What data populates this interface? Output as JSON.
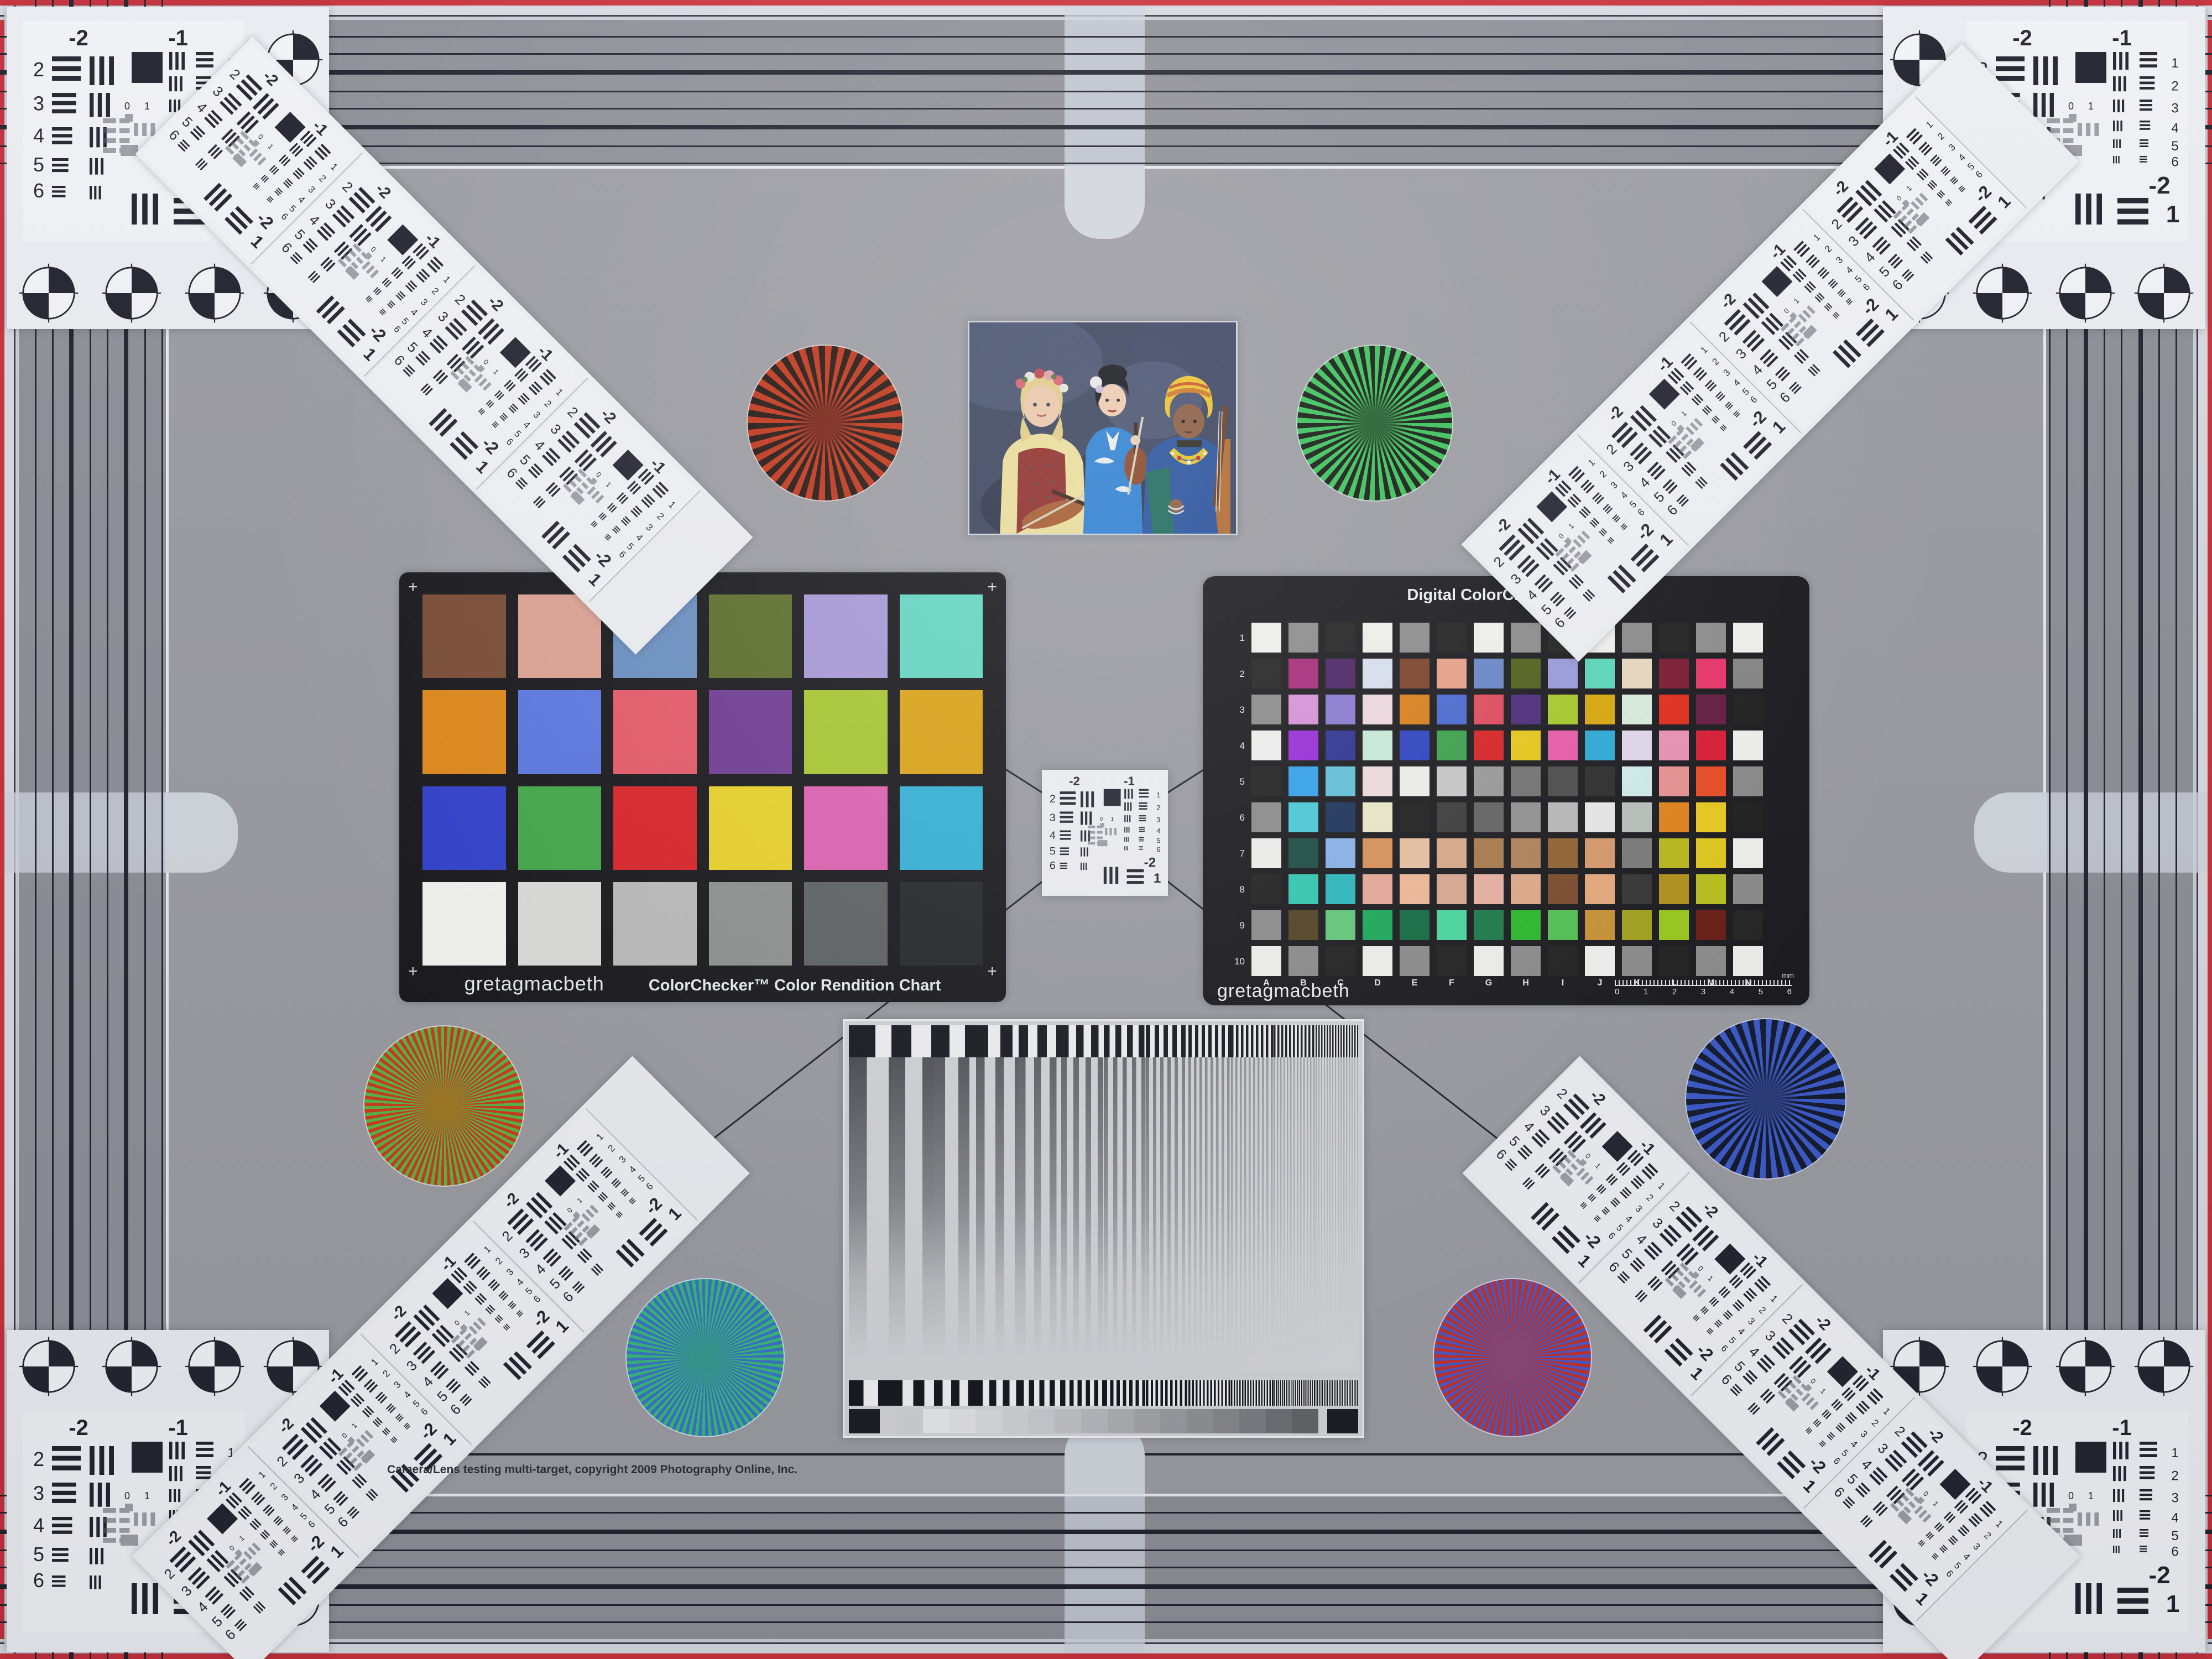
{
  "page": {
    "kind": "camera-lens-multi-target-test-chart"
  },
  "colors": {
    "edge_red": "#c8303c",
    "field_gray": "#9b9ba2",
    "band_gray": "#8e8e96",
    "line_ink": "#23232e"
  },
  "footer": {
    "copyright": "Camera/Lens testing multi-target, copyright 2009 Photography Online, Inc."
  },
  "colorchecker": {
    "brand": "gretagmacbeth",
    "title": "ColorChecker™ Color Rendition Chart",
    "corner_mark": "+",
    "patch_names": [
      "dark-skin",
      "light-skin",
      "blue-sky",
      "foliage",
      "blue-flower",
      "bluish-green",
      "orange",
      "purplish-blue",
      "moderate-red",
      "purple",
      "yellow-green",
      "orange-yellow",
      "blue",
      "green",
      "red",
      "yellow",
      "magenta",
      "cyan",
      "white",
      "neutral-8",
      "neutral-6.5",
      "neutral-5",
      "neutral-3.5",
      "black"
    ],
    "patches": [
      "#7a4b34",
      "#dda293",
      "#6a90c2",
      "#5c6e2a",
      "#a79ad8",
      "#63d8c2",
      "#e18818",
      "#5a78e2",
      "#e85a68",
      "#6e3a92",
      "#a9c930",
      "#dda414",
      "#3140cc",
      "#41a848",
      "#da2228",
      "#ead428",
      "#df62b2",
      "#32b2d8",
      "#f5f5f1",
      "#dddddb",
      "#bcbcbc",
      "#8f9190",
      "#5d6161",
      "#232527"
    ]
  },
  "sg": {
    "title": "Digital ColorChecker® SG",
    "brand": "gretagmacbeth",
    "row_labels": [
      "1",
      "2",
      "3",
      "4",
      "5",
      "6",
      "7",
      "8",
      "9",
      "10"
    ],
    "col_labels": [
      "A",
      "B",
      "C",
      "D",
      "E",
      "F",
      "G",
      "H",
      "I",
      "J",
      "K",
      "L",
      "M",
      "N"
    ],
    "ruler": {
      "ticks": [
        "0",
        "1",
        "2",
        "3",
        "4",
        "5",
        "6"
      ],
      "unit": "mm"
    },
    "patches": [
      [
        "#f2f2ee",
        "#8c8c8c",
        "#1f1f1f",
        "#f2f2ee",
        "#8c8c8c",
        "#1f1f1f",
        "#f2f2ee",
        "#8c8c8c",
        "#1f1f1f",
        "#f2f2ee",
        "#8c8c8c",
        "#1f1f1f",
        "#8c8c8c",
        "#f2f2ee"
      ],
      [
        "#202020",
        "#a82878",
        "#4a2162",
        "#dae2f2",
        "#7c4128",
        "#eaa28a",
        "#6888ca",
        "#525f1a",
        "#9a9ada",
        "#5ad8ba",
        "#ead9c2",
        "#7a1830",
        "#ea3168",
        "#848484"
      ],
      [
        "#8c8c8c",
        "#da92da",
        "#8a7ad2",
        "#f2dae2",
        "#da8118",
        "#4a68d2",
        "#e24a5a",
        "#4a2a7a",
        "#aaca2a",
        "#daa80a",
        "#daeede",
        "#e22a1a",
        "#62193f",
        "#1c1c1c"
      ],
      [
        "#f2f2ee",
        "#9a2ada",
        "#2a3192",
        "#caeeda",
        "#2a41c2",
        "#3aa24a",
        "#da2121",
        "#eaca18",
        "#ea5aaa",
        "#2aaada",
        "#e2daee",
        "#ea92b2",
        "#da1932",
        "#f2f2ee"
      ],
      [
        "#1f1f1f",
        "#32a2ea",
        "#62c2da",
        "#f2dede",
        "#f1f1ed",
        "#cacaca",
        "#9a9a9a",
        "#727272",
        "#4a4a4a",
        "#2a2a2a",
        "#d2eeee",
        "#ea9292",
        "#ea4a22",
        "#8a8a8a"
      ],
      [
        "#8c8c8c",
        "#4acada",
        "#1a315a",
        "#eeeaca",
        "#1c1c1c",
        "#3a3a3a",
        "#626262",
        "#929292",
        "#bababa",
        "#eaeaea",
        "#bac2bc",
        "#e28218",
        "#eaca1a",
        "#1c1c1c"
      ],
      [
        "#f2f2ee",
        "#1a4a42",
        "#8ab2ea",
        "#da9258",
        "#eac2a2",
        "#daaa8a",
        "#aa7a4a",
        "#b2825a",
        "#926232",
        "#da9a6a",
        "#7a7a7a",
        "#baba1a",
        "#e2ca1a",
        "#f2f2ee"
      ],
      [
        "#1f1f1f",
        "#32cab2",
        "#2ababe",
        "#eaaa9a",
        "#f2ba9a",
        "#daaa92",
        "#eab2a2",
        "#e2aa8a",
        "#7a4a2a",
        "#eaaa7a",
        "#323232",
        "#b2921a",
        "#bac21a",
        "#8a8a8a"
      ],
      [
        "#8c8c8c",
        "#524222",
        "#62ca7a",
        "#1aaa5a",
        "#126a42",
        "#4adaa2",
        "#1a7a4a",
        "#2aba2a",
        "#52c252",
        "#ca9232",
        "#a2a21a",
        "#9aca1a",
        "#681a12",
        "#212121"
      ],
      [
        "#f2f2ee",
        "#8c8c8c",
        "#1f1f1f",
        "#f2f2ee",
        "#8c8c8c",
        "#1f1f1f",
        "#f2f2ee",
        "#8c8c8c",
        "#1f1f1f",
        "#f2f2ee",
        "#8c8c8c",
        "#1f1f1f",
        "#8c8c8c",
        "#f2f2ee"
      ]
    ]
  },
  "usaf": {
    "top_labels": [
      "-2",
      "-1"
    ],
    "left_labels": [
      "2",
      "3",
      "4",
      "5",
      "6"
    ],
    "right_labels": [
      "1",
      "2",
      "3",
      "4",
      "5",
      "6"
    ],
    "bottom_labels": [
      "-2",
      "1"
    ],
    "center_labels": [
      "0",
      "1"
    ]
  },
  "stars": [
    {
      "name": "star-top-left",
      "color_a": "#c23418",
      "color_b": "#221410",
      "center": "#7a2014",
      "spokes": 36
    },
    {
      "name": "star-top-right",
      "color_a": "#38c258",
      "color_b": "#10180e",
      "center": "#1e5a28",
      "spokes": 44
    },
    {
      "name": "star-mid-left",
      "color_a": "#cc3a18",
      "color_b": "#58b44a",
      "center": "#a07820",
      "spokes": 72
    },
    {
      "name": "star-mid-right",
      "color_a": "#3a5ac8",
      "color_b": "#131a2e",
      "center": "#2a3a78",
      "spokes": 40
    },
    {
      "name": "star-bottom-left",
      "color_a": "#38b878",
      "color_b": "#3a72c8",
      "center": "#34988e",
      "spokes": 72
    },
    {
      "name": "star-bottom-right",
      "color_a": "#c23028",
      "color_b": "#5058c2",
      "center": "#8c4878",
      "spokes": 72
    }
  ],
  "wedge": {
    "bar_ink": "#17171f",
    "panel": "#d3d4d8",
    "sweep_periods": [
      96,
      72,
      56,
      44,
      34,
      27,
      21,
      16,
      12,
      9,
      7,
      5
    ],
    "body_periods": [
      72,
      56,
      44,
      35,
      28,
      22,
      17,
      13,
      10,
      8,
      6,
      5
    ],
    "steps": [
      "#d0d1d4",
      "#e8e9eb",
      "#e2e3e6",
      "#dadbde",
      "#d2d3d6",
      "#cbccd0",
      "#c2c3c7",
      "#b8b9bd",
      "#aeafb3",
      "#a4a5a9",
      "#9a9b9f",
      "#909195",
      "#86878b",
      "#7c7d81",
      "#6f7074",
      "#636468"
    ]
  },
  "photo": {
    "background": "#39425c",
    "subjects": "three musicians portrait"
  }
}
